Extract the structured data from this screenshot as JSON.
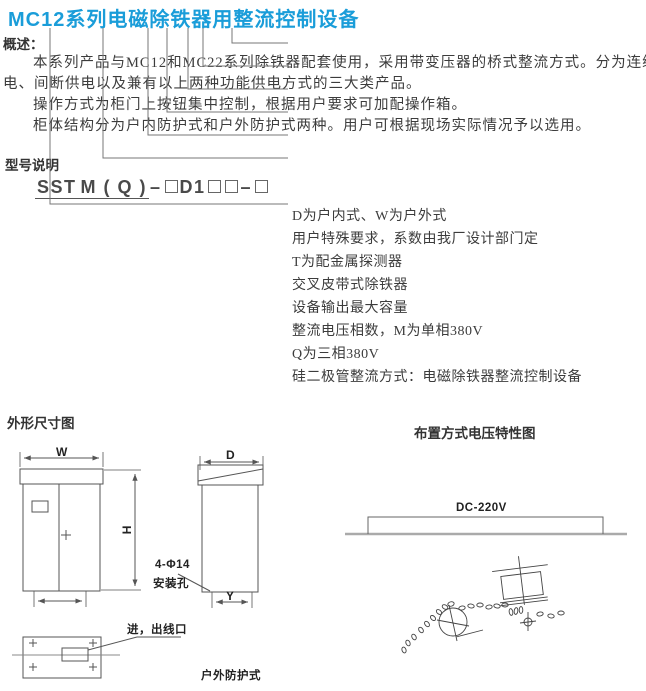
{
  "colors": {
    "heading_blue": "#1a9dd9"
  },
  "page": {
    "title": "MC12系列电磁除铁器用整流控制设备"
  },
  "overview": {
    "heading": "概述：",
    "lines": [
      "本系列产品与MC12和MC22系列除铁器配套使用，采用带变压器的桥式整流方式。分为连续供",
      "电、间断供电以及兼有以上两种功能供电方式的三大类产品。",
      "操作方式为柜门上按钮集中控制，根据用户要求可加配操作箱。",
      "柜体结构分为户内防护式和户外防护式两种。用户可根据现场实际情况予以选用。"
    ]
  },
  "model": {
    "heading": "型号说明",
    "code": {
      "seg1": "SST",
      "seg2": "M ( Q )",
      "dash1": "–",
      "d1": "D1",
      "dash2": "–"
    },
    "labels": [
      "D为户内式、W为户外式",
      "用户特殊要求，系数由我厂设计部门定",
      "T为配金属探测器",
      "交叉皮带式除铁器",
      "设备输出最大容量",
      "整流电压相数，M为单相380V",
      "Q为三相380V",
      "硅二极管整流方式：电磁除铁器整流控制设备"
    ]
  },
  "drawing": {
    "heading": "外形尺寸图",
    "width_label": "W",
    "height_label": "H",
    "depth_label": "D",
    "foot_label": "Y",
    "holes_note_1": "4-Φ14",
    "holes_note_2": "安装孔",
    "port_label": "进，出线口",
    "caption_outdoor": "户外防护式"
  },
  "voltage": {
    "heading": "布置方式电压特性图",
    "dc_label": "DC-220V"
  }
}
